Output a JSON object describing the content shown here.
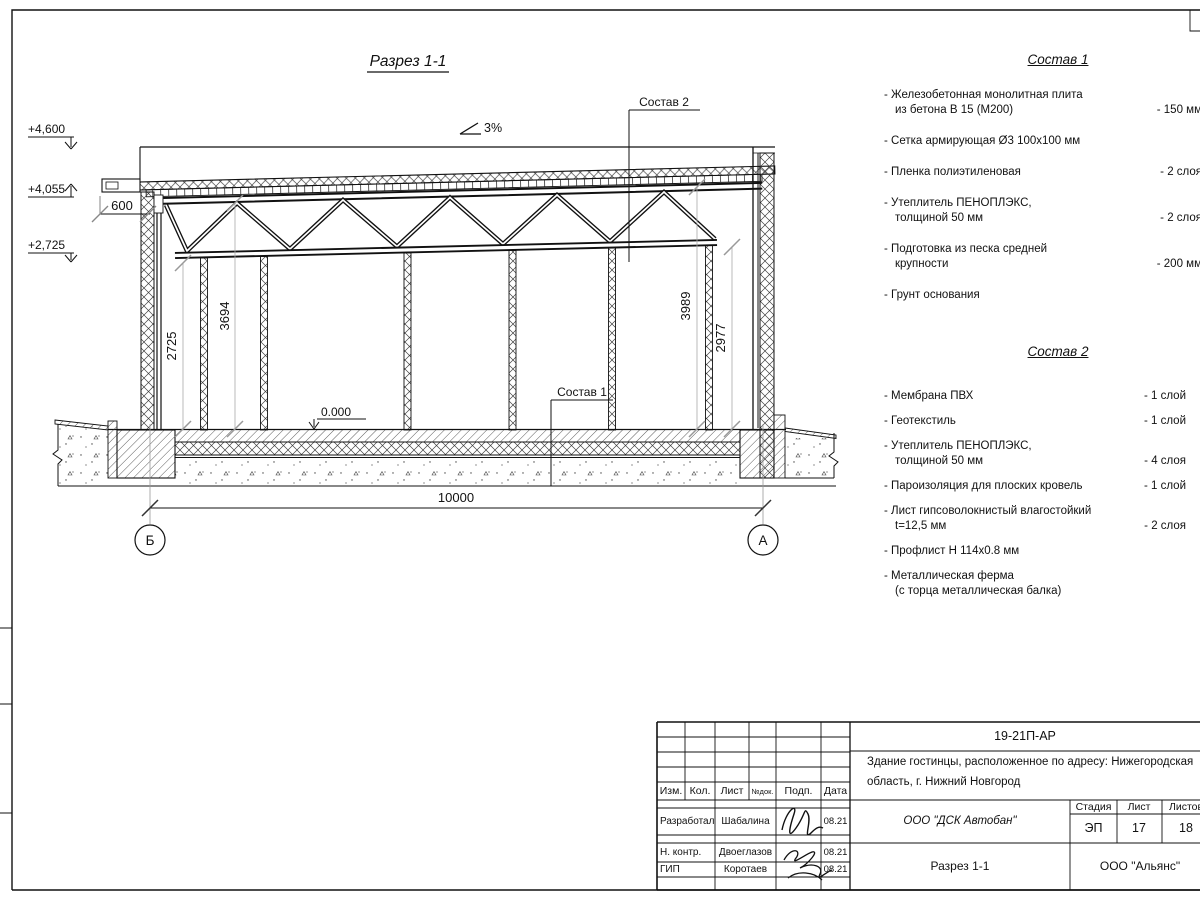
{
  "drawing": {
    "title": "Разрез 1-1",
    "slope": "3%",
    "elevations": [
      "+4,600",
      "+4,055",
      "+2,725"
    ],
    "level_zero": "0.000",
    "overhang_dim": "600",
    "span_dim": "10000",
    "vertical_dims": [
      "2725",
      "3694",
      "3989",
      "2977"
    ],
    "axis_left": "Б",
    "axis_right": "А",
    "callout_1": "Состав 1",
    "callout_2": "Состав 2"
  },
  "sostav1": {
    "title": "Состав 1",
    "items": [
      {
        "lines": [
          "- Железобетонная  монолитная плита",
          "из бетона В 15 (М200)"
        ],
        "value": "- 150 мм"
      },
      {
        "lines": [
          "- Сетка армирующая Ø3 100х100 мм"
        ]
      },
      {
        "lines": [
          "- Пленка полиэтиленовая"
        ],
        "value": "-  2 слоя"
      },
      {
        "lines": [
          "- Утеплитель ПЕНОПЛЭКС,",
          "толщиной 50 мм"
        ],
        "value": "- 2 слоя"
      },
      {
        "lines": [
          "- Подготовка из песка средней",
          "крупности"
        ],
        "value": "- 200 мм"
      },
      {
        "lines": [
          "- Грунт основания"
        ]
      }
    ]
  },
  "sostav2": {
    "title": "Состав 2",
    "items": [
      {
        "lines": [
          "- Мембрана ПВХ"
        ],
        "value": "- 1 слой"
      },
      {
        "lines": [
          "- Геотекстиль"
        ],
        "value": "- 1 слой"
      },
      {
        "lines": [
          "- Утеплитель ПЕНОПЛЭКС,",
          "толщиной 50 мм"
        ],
        "value": "- 4 слоя"
      },
      {
        "lines": [
          "- Пароизоляция для плоских кровель"
        ],
        "value": "- 1 слой"
      },
      {
        "lines": [
          "- Лист гипсоволокнистый влагостойкий",
          "t=12,5 мм"
        ],
        "value": "- 2 слоя"
      },
      {
        "lines": [
          "- Профлист Н 114х0.8 мм"
        ]
      },
      {
        "lines": [
          "- Металлическая ферма",
          "(с торца металлическая балка)"
        ]
      }
    ]
  },
  "titleblock": {
    "doc_number": "19-21П-АР",
    "object_line1": "Здание гостинцы, расположенное по адресу: Нижегородская",
    "object_line2": "область, г. Нижний Новгород",
    "headers": {
      "izm": "Изм.",
      "kol": "Кол.",
      "list": "Лист",
      "ndok": "№док.",
      "podp": "Подп.",
      "data": "Дата"
    },
    "rows": [
      {
        "role": "Разработал",
        "name": "Шабалина",
        "date": "08.21"
      },
      {
        "role": "Н. контр.",
        "name": "Двоеглазов",
        "date": "08.21"
      },
      {
        "role": "ГИП",
        "name": "Коротаев",
        "date": "08.21"
      }
    ],
    "company": "ООО \"ДСК Автобан\"",
    "stage_label": "Стадия",
    "sheet_label": "Лист",
    "sheets_label": "Листов",
    "stage": "ЭП",
    "sheet": "17",
    "sheets": "18",
    "sheet_title": "Разрез 1-1",
    "firm": "ООО \"Альянс\""
  }
}
